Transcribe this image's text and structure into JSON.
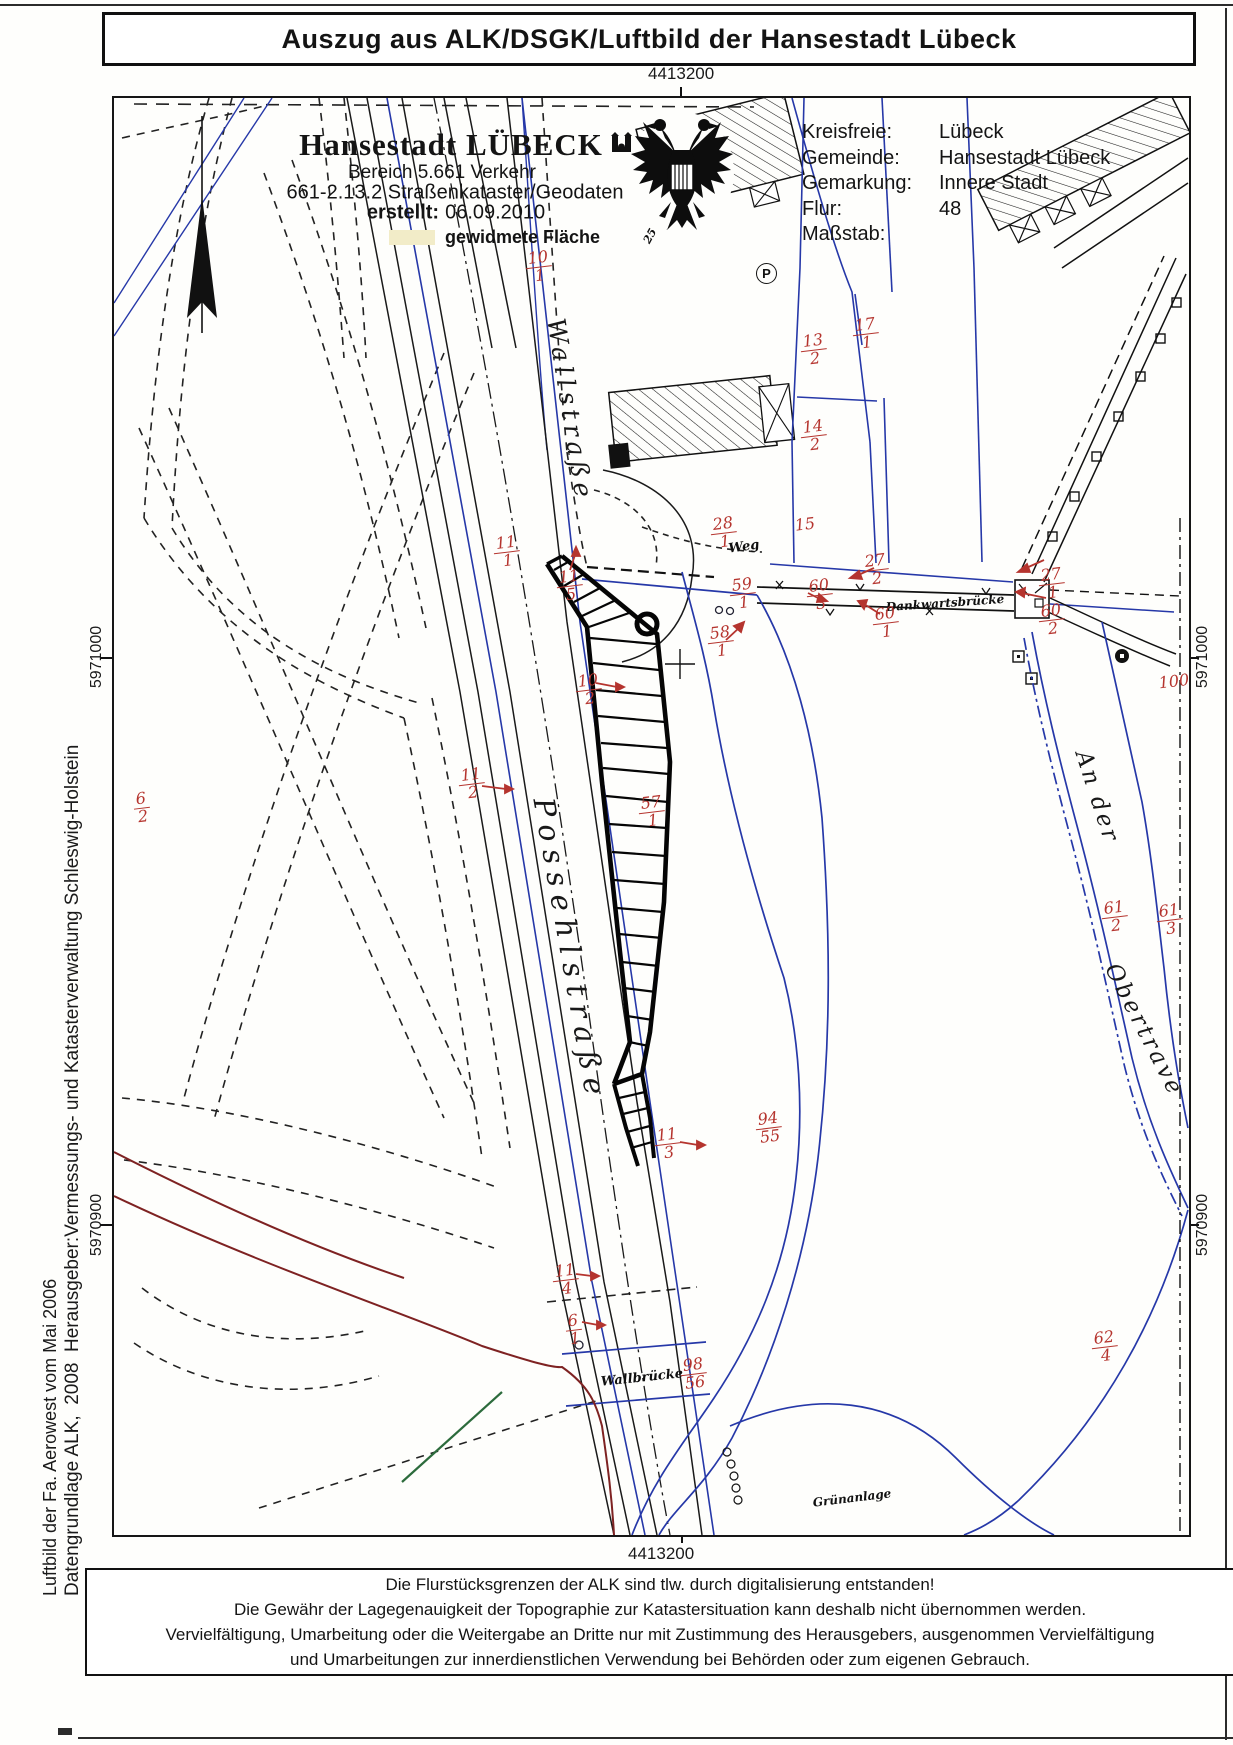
{
  "title": "Auszug aus ALK/DSGK/Luftbild der Hansestadt Lübeck",
  "header": {
    "org": "Hansestadt LÜBECK",
    "dept": "Bereich 5.661 Verkehr",
    "unit": "661-2.13.2 Straßenkataster/Geodaten",
    "created_label": "erstellt:",
    "created_date": "06.09.2010",
    "legend_label": "gewidmete Fläche"
  },
  "info": {
    "rows": [
      {
        "label": "Kreisfreie:",
        "value": "Lübeck"
      },
      {
        "label": "Gemeinde:",
        "value": "Hansestadt Lübeck"
      },
      {
        "label": "Gemarkung:",
        "value": "Innere Stadt"
      },
      {
        "label": "Flur:",
        "value": "48"
      },
      {
        "label": "Maßstab:",
        "value": ""
      }
    ]
  },
  "coordinates": {
    "top": "4413200",
    "bottom": "4413200",
    "left_upper": "5971000",
    "left_lower": "5970900",
    "right_upper": "5971000",
    "right_lower": "5970900"
  },
  "map": {
    "parking_symbol": "P",
    "streets": [
      {
        "text": "Wallstraße",
        "x": 456,
        "y": 312,
        "r": 81,
        "size": 25,
        "ls": 5
      },
      {
        "text": "Possehlstraße",
        "x": 456,
        "y": 852,
        "r": 80,
        "size": 29,
        "ls": 8
      },
      {
        "text": "An der",
        "x": 983,
        "y": 699,
        "r": 72,
        "size": 23,
        "ls": 3
      },
      {
        "text": "Obertrave",
        "x": 1030,
        "y": 932,
        "r": 63,
        "size": 23,
        "ls": 3
      }
    ],
    "places": [
      {
        "text": "Weg",
        "x": 630,
        "y": 449,
        "r": -8,
        "size": 13
      },
      {
        "text": "Dankwartsbrücke",
        "x": 831,
        "y": 505,
        "r": -4,
        "size": 12
      },
      {
        "text": "Wallbrücke",
        "x": 528,
        "y": 1280,
        "r": -6,
        "size": 13
      },
      {
        "text": "Grünanlage",
        "x": 738,
        "y": 1400,
        "r": 0,
        "size": 12
      },
      {
        "text": "25",
        "x": 536,
        "y": 138,
        "r": -62,
        "size": 11
      }
    ],
    "parcels": [
      {
        "num": "10",
        "den": "1",
        "x": 425,
        "y": 169
      },
      {
        "num": "13",
        "den": "2",
        "x": 700,
        "y": 252
      },
      {
        "num": "17",
        "den": "1",
        "x": 752,
        "y": 236
      },
      {
        "num": "14",
        "den": "2",
        "x": 700,
        "y": 338
      },
      {
        "num": "28",
        "den": "1",
        "x": 610,
        "y": 435
      },
      {
        "num": "15",
        "x": 691,
        "y": 427
      },
      {
        "num": "27",
        "den": "2",
        "x": 762,
        "y": 472
      },
      {
        "num": "59",
        "den": "1",
        "x": 629,
        "y": 496
      },
      {
        "num": "60",
        "den": "3",
        "x": 706,
        "y": 497
      },
      {
        "num": "60",
        "den": "1",
        "x": 772,
        "y": 525
      },
      {
        "num": "58",
        "den": "1",
        "x": 607,
        "y": 544
      },
      {
        "num": "27",
        "den": "1",
        "x": 938,
        "y": 486
      },
      {
        "num": "60",
        "den": "2",
        "x": 938,
        "y": 522
      },
      {
        "num": "100",
        "x": 1060,
        "y": 584
      },
      {
        "num": "11",
        "den": "1",
        "x": 393,
        "y": 454
      },
      {
        "num": "11",
        "den": "5",
        "x": 456,
        "y": 488
      },
      {
        "num": "10",
        "den": "2",
        "x": 475,
        "y": 592
      },
      {
        "num": "11",
        "den": "2",
        "x": 358,
        "y": 686
      },
      {
        "num": "57",
        "den": "1",
        "x": 538,
        "y": 714
      },
      {
        "num": "6",
        "den": "2",
        "x": 28,
        "y": 710
      },
      {
        "num": "61",
        "den": "2",
        "x": 1001,
        "y": 819
      },
      {
        "num": "61",
        "den": "3",
        "x": 1056,
        "y": 822
      },
      {
        "num": "94",
        "den": "55",
        "x": 655,
        "y": 1030
      },
      {
        "num": "11",
        "den": "3",
        "x": 554,
        "y": 1046
      },
      {
        "num": "62",
        "den": "4",
        "x": 991,
        "y": 1249
      },
      {
        "num": "11",
        "den": "4",
        "x": 452,
        "y": 1182
      },
      {
        "num": "6",
        "den": "1",
        "x": 460,
        "y": 1232
      },
      {
        "num": "98",
        "den": "56",
        "x": 580,
        "y": 1276
      }
    ]
  },
  "margin_left": {
    "line1": "Luftbild der Fa. Aerowest vom Mai 2006",
    "line2": "Datengrundlage ALK,  2008  Herausgeber:Vermessungs- und Katasterverwaltung Schleswig-Holstein"
  },
  "disclaimer": {
    "lines": [
      "Die Flurstücksgrenzen der ALK sind tlw. durch digitalisierung entstanden!",
      "Die Gewähr der Lagegenauigkeit der Topographie zur Katastersituation kann deshalb nicht übernommen werden.",
      "Vervielfältigung, Umarbeitung oder die Weitergabe an Dritte nur mit Zustimmung des Herausgebers, ausgenommen Vervielfältigung",
      "und Umarbeitungen zur innerdienstlichen Verwendung bei Behörden oder zum eigenen Gebrauch."
    ]
  },
  "colors": {
    "parcel_number": "#b5342e",
    "boundary_blue": "#2638a8",
    "ink": "#1a1a1a",
    "maroon": "#7e2222",
    "green": "#2c6b3c",
    "legend_yellow": "#f2ecc8"
  }
}
